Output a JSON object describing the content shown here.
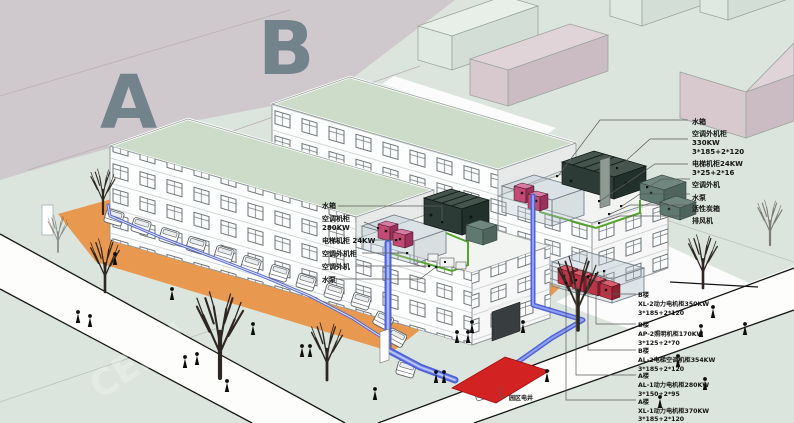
{
  "scene": {
    "building_a_letter": "A",
    "building_b_letter": "B",
    "watermark": "CEIDI"
  },
  "roof_a_labels": [
    {
      "lines": [
        "水箱"
      ]
    },
    {
      "lines": [
        "空调机柜",
        "280KW"
      ]
    },
    {
      "lines": [
        "电梯机柜 24KW"
      ]
    },
    {
      "lines": [
        "空调外机柜"
      ]
    },
    {
      "lines": [
        "空调外机"
      ]
    },
    {
      "lines": [
        "水泵"
      ]
    }
  ],
  "roof_b_labels": [
    {
      "lines": [
        "水箱"
      ]
    },
    {
      "lines": [
        "空调外机柜",
        "330KW",
        "3*185+2*120"
      ]
    },
    {
      "lines": [
        "电梯机柜24KW",
        "3*25+2*16"
      ]
    },
    {
      "lines": [
        "空调外机"
      ]
    },
    {
      "lines": [
        "水泵"
      ]
    },
    {
      "lines": [
        "活性炭箱"
      ]
    },
    {
      "lines": [
        "排风机"
      ]
    }
  ],
  "cabinet_labels": [
    {
      "lines": [
        "B楼",
        "XL-2动力电机柜350KW",
        "3*185+2*120"
      ]
    },
    {
      "lines": [
        "B楼",
        "AP-2照明机柜170KW",
        "3*125+2*70"
      ]
    },
    {
      "lines": [
        "B楼",
        "AL-2电梯空调机柜354KW",
        "3*185+2*120"
      ]
    },
    {
      "lines": [
        "A楼",
        "AL-1动力电机柜280KW",
        "3*150+2*95"
      ]
    },
    {
      "lines": [
        "A楼",
        "XL-1动力电机柜370KW",
        "3*185+2*120"
      ]
    }
  ],
  "ground_label": "园区电井",
  "colors": {
    "background_mauve": "#cfc8cd",
    "ground_mint": "#dbe5dd",
    "parking_orange": "#e9994f",
    "pipe_blue": "#5565d2",
    "pipe_green": "#54a52c",
    "equipment_pink": "#c34a74",
    "equipment_dark": "#2c3b36",
    "cabinet_red": "#c23246",
    "utility_red": "#d32222",
    "roof_green": "#cddcc8",
    "letter_gray": "#6b7e87"
  }
}
